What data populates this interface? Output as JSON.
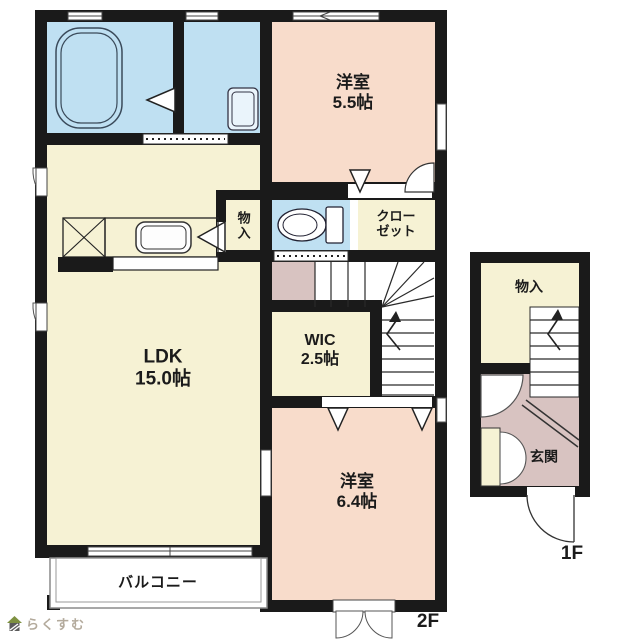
{
  "colors": {
    "cream": "#F6F2D4",
    "peach": "#F8DCCB",
    "blue": "#BFE0F2",
    "mauve": "#D8C3C1",
    "wall": "#1A1A1A",
    "white": "#FFFFFF"
  },
  "floor2": {
    "western_room_55": {
      "name": "洋室",
      "size": "5.5帖"
    },
    "storage": {
      "name": "物入"
    },
    "closet": {
      "line1": "クロー",
      "line2": "ゼット"
    },
    "wic": {
      "name": "WIC",
      "size": "2.5帖"
    },
    "ldk": {
      "name": "LDK",
      "size": "15.0帖"
    },
    "western_room_64": {
      "name": "洋室",
      "size": "6.4帖"
    },
    "balcony": {
      "name": "バルコニー"
    },
    "floor_label": "2F"
  },
  "floor1": {
    "storage": {
      "name": "物入"
    },
    "entrance": {
      "name": "玄関"
    },
    "floor_label": "1F"
  },
  "logo": {
    "text": "らくすむ"
  }
}
